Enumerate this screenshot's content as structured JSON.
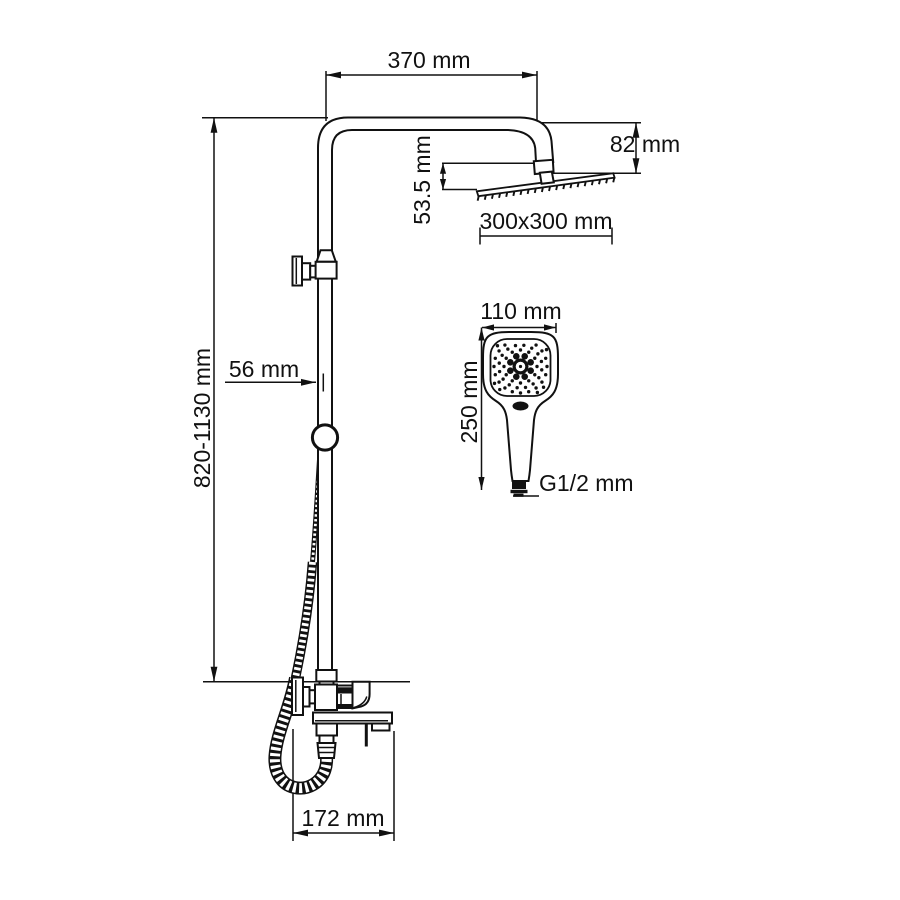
{
  "drawing": {
    "description": "Technical dimension drawing of a shower column with overhead rain shower head, hand shower and bath spout mixer",
    "background_color": "#ffffff",
    "line_color": "#111111"
  },
  "dimensions": {
    "arm_length": "370 mm",
    "head_height": "82 mm",
    "head_offset": "53.5 mm",
    "head_size": "300x300 mm",
    "column_height": "820-1130 mm",
    "wall_offset": "56 mm",
    "handshower_width": "110 mm",
    "handshower_length": "250 mm",
    "connection_thread": "G1/2 mm",
    "spout_reach": "172 mm"
  }
}
